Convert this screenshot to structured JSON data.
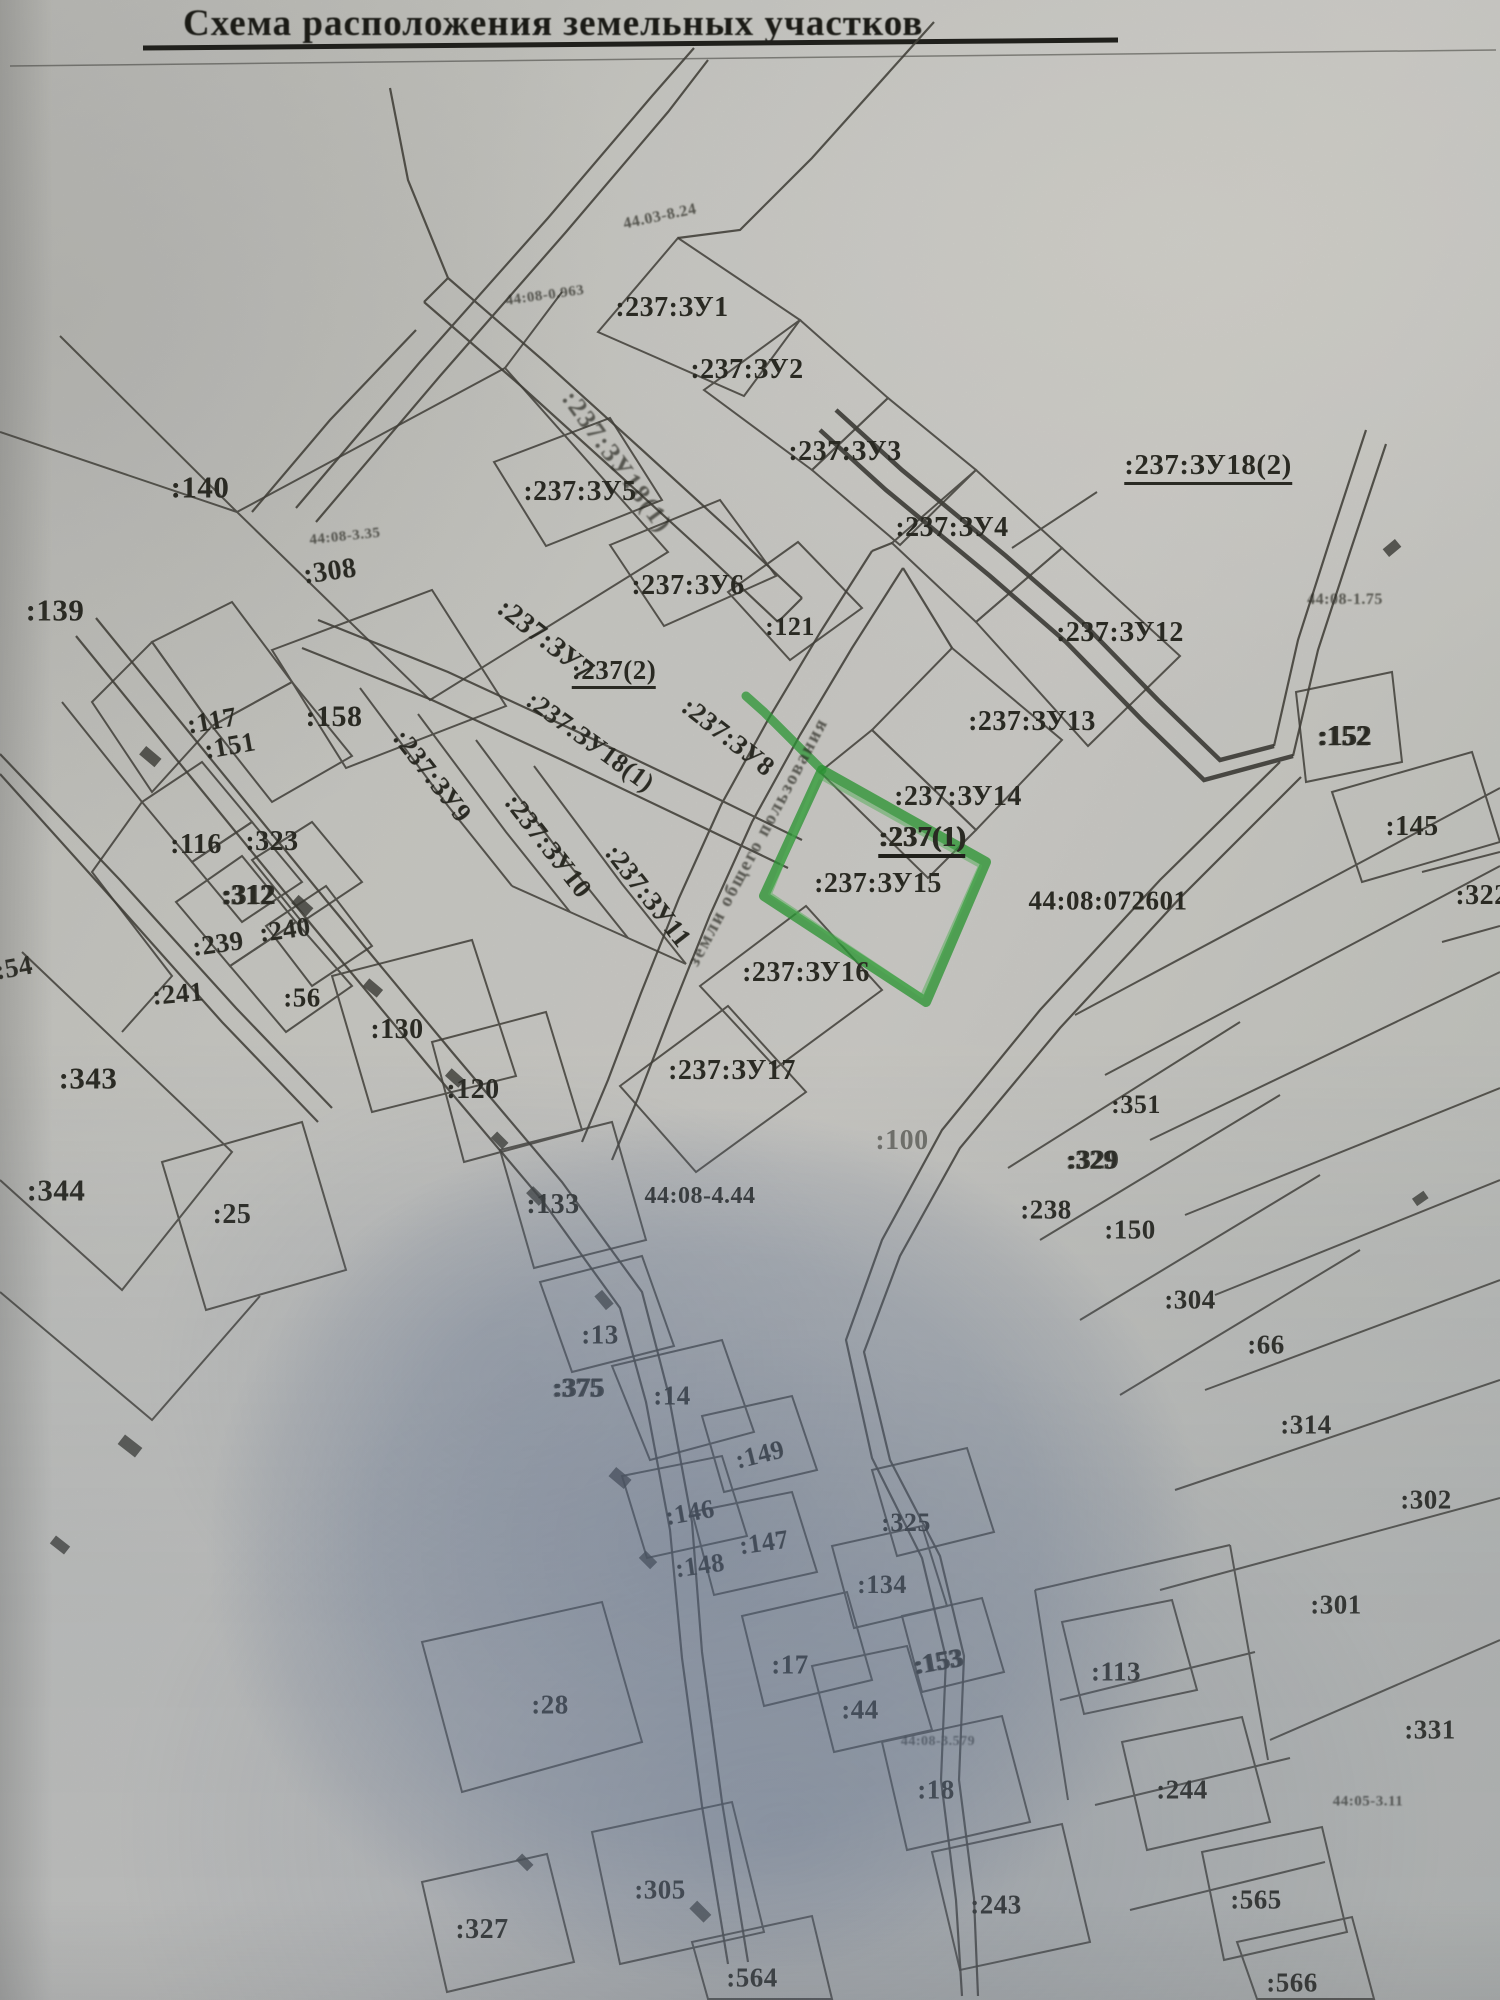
{
  "title": "Схема расположения земельных участков",
  "map": {
    "highlighted_parcel_label": ":237:ЗУ15",
    "highlight_color": "#2f9e38",
    "line_color": "#45433c",
    "cadastral_quarter_label": "44:08:072601",
    "labels": [
      {
        "t": "44.03-8.24",
        "x": 660,
        "y": 217,
        "s": 16,
        "r": -12,
        "f": "fuzzy"
      },
      {
        "t": "44:08-0.963",
        "x": 545,
        "y": 296,
        "s": 15,
        "r": -8,
        "f": "fuzzy"
      },
      {
        "t": ":237:ЗУ1",
        "x": 672,
        "y": 308,
        "s": 28
      },
      {
        "t": ":237:ЗУ2",
        "x": 747,
        "y": 370,
        "s": 28
      },
      {
        "t": ":237:ЗУ3",
        "x": 845,
        "y": 452,
        "s": 28
      },
      {
        "t": ":237:ЗУ18(2)",
        "x": 1208,
        "y": 468,
        "s": 29,
        "f": "underline"
      },
      {
        "t": ":237:ЗУ5",
        "x": 580,
        "y": 492,
        "s": 28
      },
      {
        "t": ":237:ЗУ18(1)",
        "x": 617,
        "y": 462,
        "s": 26,
        "r": 54,
        "f": "fuzzy-strip"
      },
      {
        "t": ":237:ЗУ4",
        "x": 952,
        "y": 528,
        "s": 28
      },
      {
        "t": "44:08-3.35",
        "x": 345,
        "y": 537,
        "s": 15,
        "r": -6,
        "f": "fuzzy"
      },
      {
        "t": ":308",
        "x": 330,
        "y": 572,
        "s": 28,
        "r": -8
      },
      {
        "t": ":140",
        "x": 200,
        "y": 487,
        "s": 31
      },
      {
        "t": ":139",
        "x": 55,
        "y": 610,
        "s": 31
      },
      {
        "t": "44:08-1.75",
        "x": 1345,
        "y": 600,
        "s": 16,
        "f": "fuzzy"
      },
      {
        "t": ":237:ЗУ6",
        "x": 688,
        "y": 586,
        "s": 28
      },
      {
        "t": ":121",
        "x": 790,
        "y": 627,
        "s": 26
      },
      {
        "t": ":237:ЗУ12",
        "x": 1120,
        "y": 633,
        "s": 28
      },
      {
        "t": ":237:ЗУ7",
        "x": 545,
        "y": 640,
        "s": 28,
        "r": 38
      },
      {
        "t": ":237(2)",
        "x": 614,
        "y": 673,
        "s": 27,
        "f": "underline"
      },
      {
        "t": ":237:ЗУ8",
        "x": 728,
        "y": 737,
        "s": 27,
        "r": 38
      },
      {
        "t": ":237:ЗУ18(1)",
        "x": 590,
        "y": 742,
        "s": 26,
        "r": 36
      },
      {
        "t": ":158",
        "x": 334,
        "y": 717,
        "s": 30
      },
      {
        "t": ":117",
        "x": 212,
        "y": 721,
        "s": 27,
        "r": -10
      },
      {
        "t": ":151",
        "x": 230,
        "y": 746,
        "s": 27,
        "r": -10
      },
      {
        "t": ":237:ЗУ9",
        "x": 432,
        "y": 776,
        "s": 27,
        "r": 52
      },
      {
        "t": ":237:ЗУ10",
        "x": 548,
        "y": 846,
        "s": 27,
        "r": 52
      },
      {
        "t": ":237:ЗУ11",
        "x": 648,
        "y": 896,
        "s": 27,
        "r": 52
      },
      {
        "t": "земли общего пользования",
        "x": 758,
        "y": 842,
        "s": 19,
        "r": -62,
        "f": "fuzzy-strip"
      },
      {
        "t": ":237:ЗУ13",
        "x": 1032,
        "y": 722,
        "s": 28
      },
      {
        "t": ":237:ЗУ14",
        "x": 958,
        "y": 797,
        "s": 28
      },
      {
        "t": ":237(1)",
        "x": 922,
        "y": 841,
        "s": 28,
        "f": "underline-bold"
      },
      {
        "t": ":237:ЗУ15",
        "x": 878,
        "y": 884,
        "s": 28
      },
      {
        "t": "44:08:072601",
        "x": 1108,
        "y": 901,
        "s": 27
      },
      {
        "t": ":152",
        "x": 1344,
        "y": 737,
        "s": 28,
        "f": "smudge"
      },
      {
        "t": ":145",
        "x": 1412,
        "y": 827,
        "s": 28
      },
      {
        "t": ":322",
        "x": 1482,
        "y": 896,
        "s": 28
      },
      {
        "t": ":116",
        "x": 196,
        "y": 845,
        "s": 28
      },
      {
        "t": ":323",
        "x": 272,
        "y": 842,
        "s": 28
      },
      {
        "t": ":312",
        "x": 248,
        "y": 896,
        "s": 28,
        "f": "smudge"
      },
      {
        "t": ":239",
        "x": 218,
        "y": 944,
        "s": 27,
        "r": -8
      },
      {
        "t": ":240",
        "x": 285,
        "y": 930,
        "s": 27,
        "r": -8
      },
      {
        "t": ":241",
        "x": 178,
        "y": 994,
        "s": 27,
        "r": -5
      },
      {
        "t": ":56",
        "x": 302,
        "y": 998,
        "s": 27
      },
      {
        "t": ":130",
        "x": 397,
        "y": 1030,
        "s": 28
      },
      {
        "t": ":54",
        "x": 14,
        "y": 968,
        "s": 27,
        "r": -10
      },
      {
        "t": ":343",
        "x": 88,
        "y": 1078,
        "s": 31
      },
      {
        "t": ":120",
        "x": 473,
        "y": 1090,
        "s": 28
      },
      {
        "t": ":344",
        "x": 56,
        "y": 1190,
        "s": 31
      },
      {
        "t": ":25",
        "x": 232,
        "y": 1215,
        "s": 28
      },
      {
        "t": ":133",
        "x": 553,
        "y": 1205,
        "s": 28
      },
      {
        "t": "44:08-4.44",
        "x": 700,
        "y": 1196,
        "s": 24
      },
      {
        "t": ":237:ЗУ16",
        "x": 806,
        "y": 973,
        "s": 28
      },
      {
        "t": ":237:ЗУ17",
        "x": 732,
        "y": 1071,
        "s": 28
      },
      {
        "t": ":100",
        "x": 902,
        "y": 1141,
        "s": 28,
        "f": "ghost"
      },
      {
        "t": ":351",
        "x": 1136,
        "y": 1105,
        "s": 26
      },
      {
        "t": ":329",
        "x": 1092,
        "y": 1160,
        "s": 27,
        "f": "smudge"
      },
      {
        "t": ":238",
        "x": 1046,
        "y": 1210,
        "s": 27
      },
      {
        "t": ":150",
        "x": 1130,
        "y": 1230,
        "s": 27
      },
      {
        "t": ":304",
        "x": 1190,
        "y": 1300,
        "s": 27
      },
      {
        "t": ":66",
        "x": 1266,
        "y": 1345,
        "s": 27
      },
      {
        "t": ":314",
        "x": 1306,
        "y": 1425,
        "s": 27
      },
      {
        "t": ":302",
        "x": 1426,
        "y": 1500,
        "s": 27
      },
      {
        "t": ":301",
        "x": 1336,
        "y": 1605,
        "s": 27
      },
      {
        "t": ":331",
        "x": 1430,
        "y": 1730,
        "s": 27
      },
      {
        "t": ":113",
        "x": 1116,
        "y": 1672,
        "s": 27
      },
      {
        "t": ":244",
        "x": 1182,
        "y": 1790,
        "s": 27
      },
      {
        "t": "44:05-3.11",
        "x": 1368,
        "y": 1802,
        "s": 15,
        "f": "fuzzy"
      },
      {
        "t": ":13",
        "x": 600,
        "y": 1335,
        "s": 27
      },
      {
        "t": ":375",
        "x": 578,
        "y": 1388,
        "s": 27,
        "f": "smudge"
      },
      {
        "t": ":14",
        "x": 672,
        "y": 1396,
        "s": 27
      },
      {
        "t": ":149",
        "x": 760,
        "y": 1455,
        "s": 26,
        "r": -14
      },
      {
        "t": ":146",
        "x": 690,
        "y": 1513,
        "s": 26,
        "r": -10
      },
      {
        "t": ":147",
        "x": 764,
        "y": 1543,
        "s": 26,
        "r": -8
      },
      {
        "t": ":148",
        "x": 700,
        "y": 1566,
        "s": 26,
        "r": -8
      },
      {
        "t": ":325",
        "x": 906,
        "y": 1523,
        "s": 26
      },
      {
        "t": ":134",
        "x": 882,
        "y": 1585,
        "s": 26
      },
      {
        "t": ":17",
        "x": 790,
        "y": 1665,
        "s": 27
      },
      {
        "t": ":28",
        "x": 550,
        "y": 1705,
        "s": 27
      },
      {
        "t": ":44",
        "x": 860,
        "y": 1710,
        "s": 27
      },
      {
        "t": ":153",
        "x": 938,
        "y": 1662,
        "s": 26,
        "r": -10,
        "f": "smudge"
      },
      {
        "t": "44:08-3.579",
        "x": 938,
        "y": 1742,
        "s": 14,
        "f": "fuzzy"
      },
      {
        "t": ":18",
        "x": 936,
        "y": 1790,
        "s": 27
      },
      {
        "t": ":305",
        "x": 660,
        "y": 1890,
        "s": 27
      },
      {
        "t": ":327",
        "x": 482,
        "y": 1930,
        "s": 28
      },
      {
        "t": ":243",
        "x": 996,
        "y": 1905,
        "s": 27
      },
      {
        "t": ":565",
        "x": 1256,
        "y": 1900,
        "s": 27
      },
      {
        "t": ":564",
        "x": 752,
        "y": 1978,
        "s": 27
      },
      {
        "t": ":566",
        "x": 1292,
        "y": 1983,
        "s": 27
      }
    ]
  }
}
